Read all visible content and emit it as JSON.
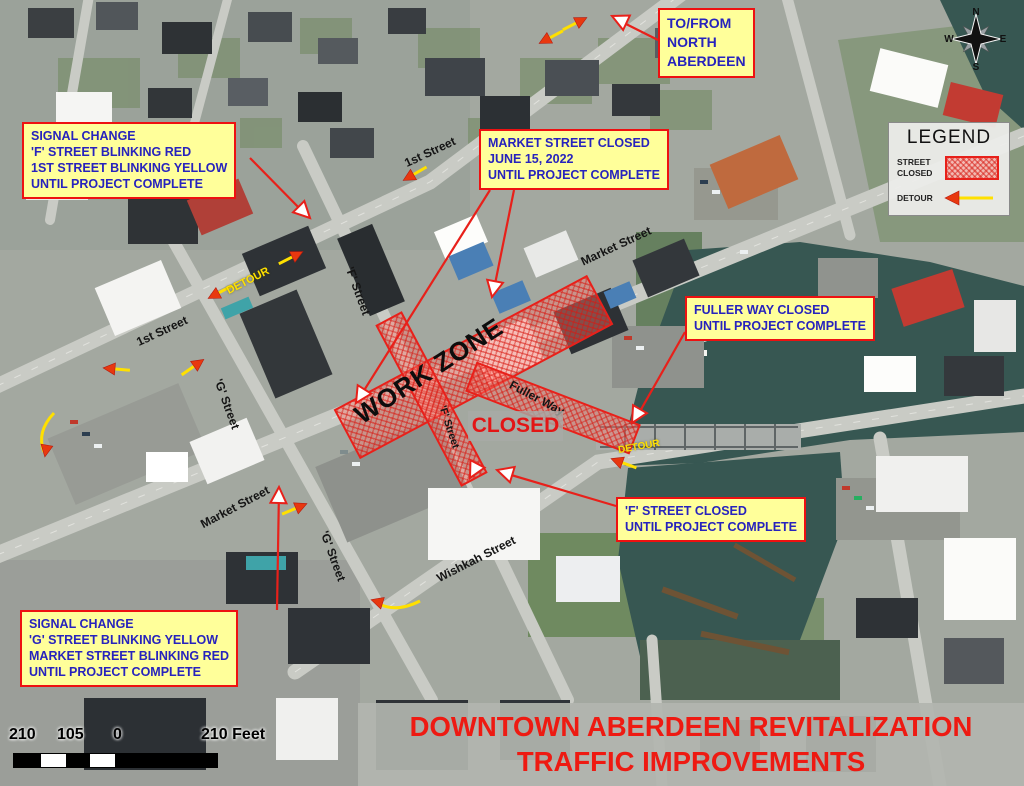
{
  "map_title": {
    "line1": "DOWNTOWN ABERDEEN REVITALIZATION",
    "line2": "TRAFFIC IMPROVEMENTS"
  },
  "callouts": {
    "signal_change_north": {
      "lines": [
        "SIGNAL CHANGE",
        "'F' STREET BLINKING RED",
        "1ST STREET BLINKING YELLOW",
        "UNTIL PROJECT COMPLETE"
      ]
    },
    "market_street_closed": {
      "lines": [
        "MARKET STREET CLOSED",
        "JUNE 15, 2022",
        "UNTIL PROJECT COMPLETE"
      ]
    },
    "to_from_north_aberdeen": {
      "lines": [
        "TO/FROM",
        "NORTH",
        "ABERDEEN"
      ]
    },
    "fuller_way_closed": {
      "lines": [
        "FULLER WAY CLOSED",
        "UNTIL PROJECT COMPLETE"
      ]
    },
    "f_street_closed": {
      "lines": [
        "'F' STREET CLOSED",
        "UNTIL PROJECT COMPLETE"
      ]
    },
    "signal_change_south": {
      "lines": [
        "SIGNAL CHANGE",
        "'G' STREET BLINKING YELLOW",
        "MARKET STREET BLINKING RED",
        "UNTIL PROJECT COMPLETE"
      ]
    }
  },
  "legend": {
    "title": "LEGEND",
    "street_closed_label": "STREET CLOSED",
    "detour_label": "DETOUR"
  },
  "compass": {
    "north": "N",
    "east": "E",
    "south": "S",
    "west": "W"
  },
  "scale_bar": {
    "left_label": "210",
    "mid_label": "105",
    "zero_label": "0",
    "right_label": "210 Feet"
  },
  "map_labels": {
    "work_zone": "WORK ZONE",
    "closed": "CLOSED",
    "detour": "DETOUR",
    "streets": {
      "first_street": "1st Street",
      "market_street": "Market Street",
      "f_street": "'F' Street",
      "g_street": "'G' Street",
      "fuller_way": "Fuller Way",
      "wishkah_street": "Wishkah Street"
    }
  },
  "colors": {
    "callout_background": "#FFFF9A",
    "callout_border": "#EE1111",
    "callout_text": "#2723BD",
    "closure_red": "#E8201A",
    "closure_fill": "#FF766C",
    "detour_yellow": "#FFE000",
    "detour_arrowhead": "#E8380F",
    "title_red": "#EE1A12",
    "river": "#375752"
  }
}
